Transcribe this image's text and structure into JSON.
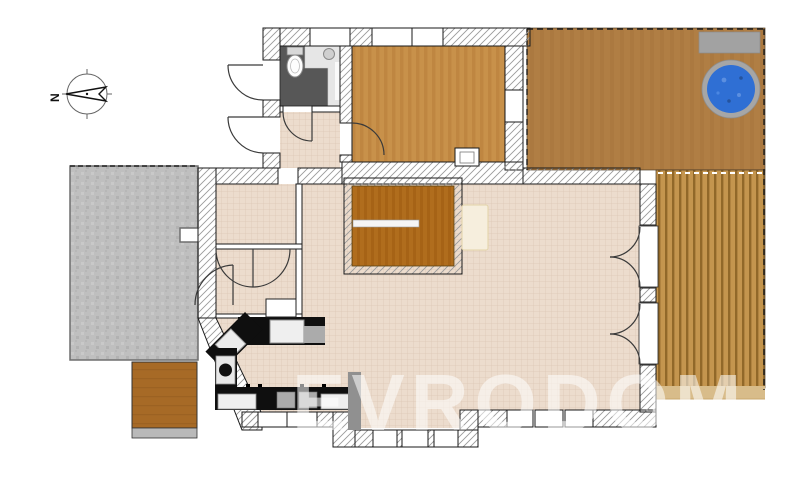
{
  "compass": {
    "label": "N",
    "direction": "north-points-left"
  },
  "watermark": {
    "text": "EVRODOM"
  },
  "colors": {
    "tile": "#ecdccd",
    "tile_grid": "#dcc7b5",
    "bedroom_wood": "#c8914a",
    "stair_wood": "#b06d1d",
    "top_deck": "#b07e44",
    "side_deck": "#c4954e",
    "side_deck_stripe": "#916829",
    "deck_edge": "#d8bc8a",
    "porch_wood": "#a76a26",
    "patio_gray": "#bfbfbf",
    "bath_floor": "#575757",
    "bath_counter": "#e6e6e6",
    "counter_black": "#0f0f0f",
    "appliance_white": "#efefef",
    "appliance_gray": "#ababab",
    "island_panel_gray": "#909090",
    "step_gray": "#b9b9b9",
    "bench_gray": "#a2a2a2",
    "hot_tub_water": "#2f6fd4",
    "hot_tub_rim": "#a6a6a6",
    "sideboard_cream": "#f6eedd",
    "wall_edge": "#1a1a1a"
  },
  "zones": [
    {
      "name": "paved-patio",
      "floor": "stone-pavers"
    },
    {
      "name": "entry-porch",
      "floor": "wood",
      "features": [
        "step"
      ]
    },
    {
      "name": "bathroom",
      "floor": "dark-tile",
      "features": [
        "toilet",
        "sink-counter"
      ]
    },
    {
      "name": "hallway",
      "floor": "tile"
    },
    {
      "name": "bedroom",
      "floor": "hardwood",
      "features": [
        "chimney-box"
      ]
    },
    {
      "name": "storage-room",
      "floor": "tile"
    },
    {
      "name": "closet-room",
      "floor": "tile",
      "features": [
        "double-closet-doors"
      ]
    },
    {
      "name": "staircase",
      "floor": "wood-steps",
      "features": [
        "handrail"
      ]
    },
    {
      "name": "living-area",
      "floor": "tile",
      "features": [
        "sideboard",
        "two-double-french-doors"
      ]
    },
    {
      "name": "kitchen",
      "floor": "tile",
      "features": [
        "l-counter",
        "sink",
        "oven",
        "dishwasher"
      ]
    },
    {
      "name": "upper-terrace",
      "floor": "wood-deck",
      "features": [
        "hot-tub",
        "bench"
      ]
    },
    {
      "name": "side-terrace",
      "floor": "wood-plank-deck"
    }
  ],
  "counts": {
    "exterior_doors": 2,
    "french_door_sets": 2,
    "windows_top": 3,
    "windows_bottom": 8
  }
}
